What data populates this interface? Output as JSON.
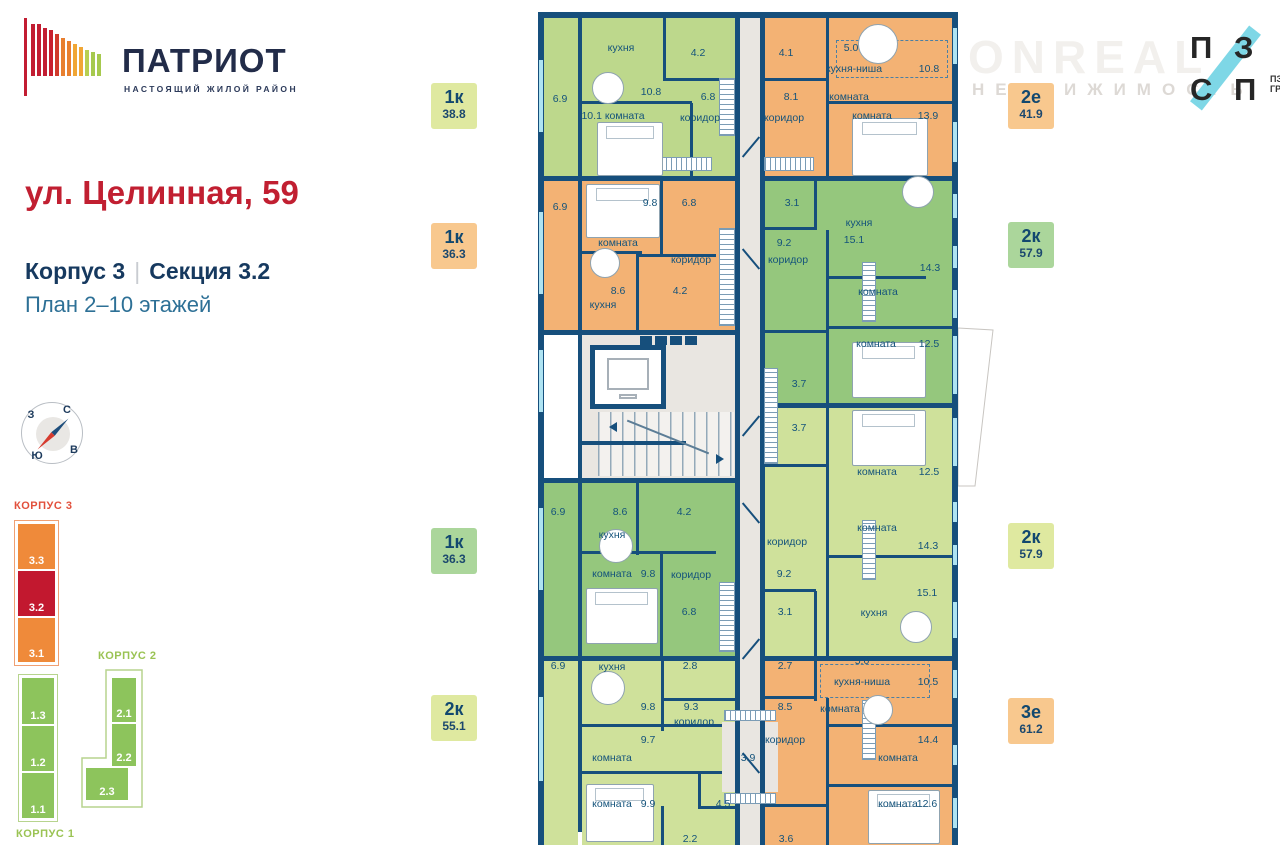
{
  "colors": {
    "wall": "#164f7c",
    "window": "#aee3f2",
    "label_text": "#14537b",
    "accent_red": "#c11f31",
    "navy": "#16395f",
    "blue": "#2d7096",
    "lime1": "#bdd88c",
    "lime2": "#cfe19b",
    "green": "#95c77d",
    "orange": "#f3b274",
    "corridor_gray": "#e9e6e1",
    "minimap_orange": "#ef8a3a",
    "minimap_red": "#c2182f",
    "minimap_green": "#8dc45c",
    "logo_cyan": "#7ed7e6"
  },
  "header": {
    "brand": "ПАТРИОТ",
    "tagline": "НАСТОЯЩИЙ ЖИЛОЙ РАЙОН",
    "address": "ул. Целинная, 59",
    "building": "Корпус 3",
    "divider": "|",
    "section": "Секция 3.2",
    "floors": "План 2–10 этажей"
  },
  "watermark": {
    "line1": "ONREAL",
    "line2": "НЕДВИЖИМОСТЬ"
  },
  "partner_logo": {
    "l1": "П",
    "l2": "З",
    "l3": "С",
    "l4": "П",
    "cap1": "ПЗСП",
    "cap2": "ГРУПП"
  },
  "compass": {
    "north": "С",
    "east": "В",
    "south": "Ю",
    "west": "З"
  },
  "minimap": {
    "k3": {
      "label": "КОРПУС 3",
      "sections": [
        "3.3",
        "3.2",
        "3.1"
      ],
      "active": "3.2"
    },
    "k2": {
      "label": "КОРПУС 2",
      "sections": [
        "2.1",
        "2.2",
        "2.3"
      ]
    },
    "k1": {
      "label": "КОРПУС 1",
      "sections": [
        "1.3",
        "1.2",
        "1.1"
      ]
    }
  },
  "apartments": [
    {
      "type": "1к",
      "area": "38.8",
      "color": "#dfe9a0",
      "side": "left"
    },
    {
      "type": "1к",
      "area": "36.3",
      "color": "#f8c88e",
      "side": "left"
    },
    {
      "type": "1к",
      "area": "36.3",
      "color": "#abd69b",
      "side": "left"
    },
    {
      "type": "2к",
      "area": "55.1",
      "color": "#dfe9a0",
      "side": "left"
    },
    {
      "type": "2е",
      "area": "41.9",
      "color": "#f8c88e",
      "side": "right"
    },
    {
      "type": "2к",
      "area": "57.9",
      "color": "#abd69b",
      "side": "right"
    },
    {
      "type": "2к",
      "area": "57.9",
      "color": "#dfe9a0",
      "side": "right"
    },
    {
      "type": "3е",
      "area": "61.2",
      "color": "#f8c88e",
      "side": "right"
    }
  ],
  "plan": {
    "rooms": [
      [
        544,
        18,
        34,
        158,
        "#bdd88c",
        "balcony-6.9",
        0
      ],
      [
        582,
        18,
        153,
        158,
        "#bdd88c",
        "apartment-1k-38.8",
        1
      ],
      [
        544,
        181,
        34,
        150,
        "#f3b274",
        "balcony-6.9",
        0
      ],
      [
        582,
        181,
        153,
        149,
        "#f3b274",
        "apartment-1k-36.3",
        1
      ],
      [
        582,
        335,
        153,
        143,
        "#e9e6e1",
        "stair-core",
        0
      ],
      [
        544,
        483,
        34,
        173,
        "#95c77d",
        "balcony-6.9",
        0
      ],
      [
        582,
        483,
        153,
        173,
        "#95c77d",
        "apartment-1k-36.3",
        1
      ],
      [
        544,
        661,
        34,
        184,
        "#cfe19b",
        "balcony-6.9",
        0
      ],
      [
        582,
        661,
        153,
        184,
        "#cfe19b",
        "apartment-2k-55.1",
        1
      ],
      [
        740,
        18,
        21,
        827,
        "#e9e6e1",
        "corridor",
        0
      ],
      [
        765,
        18,
        187,
        158,
        "#f3b274",
        "apartment-2e-41.9",
        1
      ],
      [
        765,
        181,
        187,
        222,
        "#95c77d",
        "apartment-2k-57.9",
        1
      ],
      [
        765,
        408,
        187,
        248,
        "#cfe19b",
        "apartment-2k-57.9",
        1
      ],
      [
        765,
        661,
        187,
        184,
        "#f3b274",
        "apartment-3e-61.2",
        1
      ],
      [
        722,
        722,
        56,
        70,
        "#e9e6e1",
        "wardrobe-3.9",
        0
      ]
    ],
    "walls": [
      [
        538,
        12,
        420,
        6
      ],
      [
        538,
        12,
        6,
        833
      ],
      [
        952,
        12,
        6,
        833
      ],
      [
        578,
        18,
        4,
        814
      ],
      [
        735,
        18,
        5,
        827
      ],
      [
        760,
        18,
        5,
        827
      ],
      [
        544,
        176,
        194,
        5
      ],
      [
        760,
        176,
        198,
        5
      ],
      [
        544,
        330,
        194,
        5
      ],
      [
        762,
        403,
        196,
        5
      ],
      [
        544,
        478,
        194,
        5
      ],
      [
        544,
        656,
        194,
        5
      ],
      [
        760,
        656,
        198,
        5
      ],
      [
        663,
        18,
        3,
        62
      ],
      [
        663,
        78,
        74,
        3
      ],
      [
        582,
        101,
        110,
        3
      ],
      [
        690,
        103,
        3,
        73
      ],
      [
        826,
        18,
        3,
        160
      ],
      [
        762,
        78,
        66,
        3
      ],
      [
        829,
        101,
        123,
        3
      ],
      [
        660,
        176,
        3,
        80
      ],
      [
        582,
        251,
        60,
        3
      ],
      [
        636,
        254,
        80,
        3
      ],
      [
        636,
        256,
        3,
        76
      ],
      [
        814,
        176,
        3,
        54
      ],
      [
        762,
        227,
        54,
        3
      ],
      [
        826,
        230,
        3,
        175
      ],
      [
        829,
        276,
        97,
        3
      ],
      [
        829,
        326,
        123,
        3
      ],
      [
        762,
        330,
        66,
        3
      ],
      [
        762,
        464,
        66,
        3
      ],
      [
        826,
        330,
        3,
        136
      ],
      [
        636,
        483,
        3,
        72
      ],
      [
        636,
        551,
        80,
        3
      ],
      [
        582,
        551,
        60,
        3
      ],
      [
        660,
        554,
        3,
        102
      ],
      [
        826,
        466,
        3,
        190
      ],
      [
        829,
        555,
        123,
        3
      ],
      [
        762,
        589,
        54,
        3
      ],
      [
        814,
        591,
        3,
        65
      ],
      [
        661,
        661,
        3,
        70
      ],
      [
        661,
        698,
        76,
        3
      ],
      [
        582,
        724,
        140,
        3
      ],
      [
        582,
        771,
        140,
        3
      ],
      [
        698,
        773,
        3,
        36
      ],
      [
        698,
        806,
        40,
        3
      ],
      [
        661,
        806,
        3,
        39
      ],
      [
        814,
        661,
        3,
        40
      ],
      [
        762,
        696,
        54,
        3
      ],
      [
        826,
        698,
        3,
        147
      ],
      [
        829,
        724,
        123,
        3
      ],
      [
        829,
        784,
        123,
        3
      ],
      [
        762,
        804,
        66,
        3
      ]
    ],
    "windows": [
      [
        539,
        60,
        4,
        72
      ],
      [
        539,
        212,
        4,
        82
      ],
      [
        539,
        350,
        4,
        62
      ],
      [
        539,
        508,
        4,
        82
      ],
      [
        539,
        697,
        4,
        84
      ],
      [
        953,
        28,
        4,
        36
      ],
      [
        953,
        122,
        4,
        40
      ],
      [
        953,
        194,
        4,
        24
      ],
      [
        953,
        246,
        4,
        22
      ],
      [
        953,
        290,
        4,
        28
      ],
      [
        953,
        336,
        4,
        58
      ],
      [
        953,
        418,
        4,
        48
      ],
      [
        953,
        502,
        4,
        20
      ],
      [
        953,
        545,
        4,
        20
      ],
      [
        953,
        602,
        4,
        36
      ],
      [
        953,
        670,
        4,
        28
      ],
      [
        953,
        745,
        4,
        20
      ],
      [
        953,
        798,
        4,
        30
      ]
    ],
    "hatches": [
      [
        660,
        157,
        52,
        14,
        "h"
      ],
      [
        764,
        157,
        50,
        14,
        "h"
      ],
      [
        719,
        78,
        16,
        58,
        "v"
      ],
      [
        719,
        228,
        16,
        98,
        "v"
      ],
      [
        764,
        368,
        14,
        96,
        "v"
      ],
      [
        719,
        582,
        16,
        70,
        "v"
      ],
      [
        862,
        262,
        14,
        60,
        "v"
      ],
      [
        862,
        520,
        14,
        60,
        "v"
      ],
      [
        862,
        700,
        14,
        60,
        "v"
      ],
      [
        724,
        710,
        52,
        11,
        "h"
      ],
      [
        724,
        793,
        52,
        11,
        "h"
      ]
    ],
    "dashed": [
      [
        836,
        40,
        112,
        38
      ],
      [
        820,
        664,
        110,
        34
      ]
    ],
    "beds": [
      [
        597,
        122,
        66,
        54
      ],
      [
        852,
        118,
        76,
        58
      ],
      [
        586,
        184,
        74,
        54
      ],
      [
        852,
        342,
        74,
        56
      ],
      [
        852,
        410,
        74,
        56
      ],
      [
        586,
        588,
        72,
        56
      ],
      [
        586,
        784,
        68,
        58
      ],
      [
        868,
        790,
        72,
        54
      ]
    ],
    "tables": [
      [
        608,
        88,
        16
      ],
      [
        878,
        44,
        20
      ],
      [
        605,
        263,
        15
      ],
      [
        918,
        192,
        16
      ],
      [
        616,
        546,
        17
      ],
      [
        608,
        688,
        17
      ],
      [
        878,
        710,
        15
      ],
      [
        916,
        627,
        16
      ]
    ],
    "labels": [
      [
        "6.9",
        560,
        99
      ],
      [
        "кухня",
        621,
        48
      ],
      [
        "10.8",
        651,
        92
      ],
      [
        "4.2",
        698,
        53
      ],
      [
        "6.8",
        708,
        97
      ],
      [
        "коридор",
        700,
        118
      ],
      [
        "10.1 комната",
        613,
        116
      ],
      [
        "4.1",
        786,
        53
      ],
      [
        "8.1",
        791,
        97
      ],
      [
        "коридор",
        784,
        118
      ],
      [
        "5.0",
        851,
        48
      ],
      [
        "кухня-ниша",
        854,
        69
      ],
      [
        "10.8",
        929,
        69
      ],
      [
        "комната",
        849,
        97
      ],
      [
        "комната",
        872,
        116
      ],
      [
        "13.9",
        928,
        116
      ],
      [
        "6.9",
        560,
        207
      ],
      [
        "9.8",
        650,
        203
      ],
      [
        "комната",
        618,
        243
      ],
      [
        "6.8",
        689,
        203
      ],
      [
        "коридор",
        691,
        260
      ],
      [
        "8.6",
        618,
        291
      ],
      [
        "кухня",
        603,
        305
      ],
      [
        "4.2",
        680,
        291
      ],
      [
        "3.1",
        792,
        203
      ],
      [
        "9.2",
        784,
        243
      ],
      [
        "коридор",
        788,
        260
      ],
      [
        "кухня",
        859,
        223
      ],
      [
        "15.1",
        854,
        240
      ],
      [
        "14.3",
        930,
        268
      ],
      [
        "комната",
        878,
        292
      ],
      [
        "комната",
        876,
        344
      ],
      [
        "12.5",
        929,
        344
      ],
      [
        "3.7",
        799,
        384
      ],
      [
        "3.7",
        799,
        428
      ],
      [
        "комната",
        877,
        472
      ],
      [
        "12.5",
        929,
        472
      ],
      [
        "6.9",
        558,
        512
      ],
      [
        "8.6",
        620,
        512
      ],
      [
        "4.2",
        684,
        512
      ],
      [
        "кухня",
        612,
        535
      ],
      [
        "комната",
        612,
        574
      ],
      [
        "9.8",
        648,
        574
      ],
      [
        "коридор",
        691,
        575
      ],
      [
        "6.8",
        689,
        612
      ],
      [
        "коридор",
        787,
        542
      ],
      [
        "комната",
        877,
        528
      ],
      [
        "14.3",
        928,
        546
      ],
      [
        "9.2",
        784,
        574
      ],
      [
        "3.1",
        785,
        612
      ],
      [
        "15.1",
        927,
        593
      ],
      [
        "кухня",
        874,
        613
      ],
      [
        "6.9",
        558,
        666
      ],
      [
        "кухня",
        612,
        667
      ],
      [
        "2.8",
        690,
        666
      ],
      [
        "9.8",
        648,
        707
      ],
      [
        "9.3",
        691,
        707
      ],
      [
        "коридор",
        694,
        722
      ],
      [
        "9.7",
        648,
        740
      ],
      [
        "комната",
        612,
        758
      ],
      [
        "комната",
        612,
        804
      ],
      [
        "9.9",
        648,
        804
      ],
      [
        "4.5",
        723,
        804
      ],
      [
        "2.2",
        690,
        839
      ],
      [
        "3.9",
        748,
        758
      ],
      [
        "2.7",
        785,
        666
      ],
      [
        "5.0",
        862,
        661
      ],
      [
        "кухня-ниша",
        862,
        682
      ],
      [
        "10.5",
        928,
        682
      ],
      [
        "8.5",
        785,
        707
      ],
      [
        "комната",
        840,
        709
      ],
      [
        "коридор",
        785,
        740
      ],
      [
        "14.4",
        928,
        740
      ],
      [
        "комната",
        898,
        758
      ],
      [
        "комната",
        898,
        804
      ],
      [
        "12.6",
        927,
        804
      ],
      [
        "3.6",
        786,
        839
      ]
    ]
  }
}
